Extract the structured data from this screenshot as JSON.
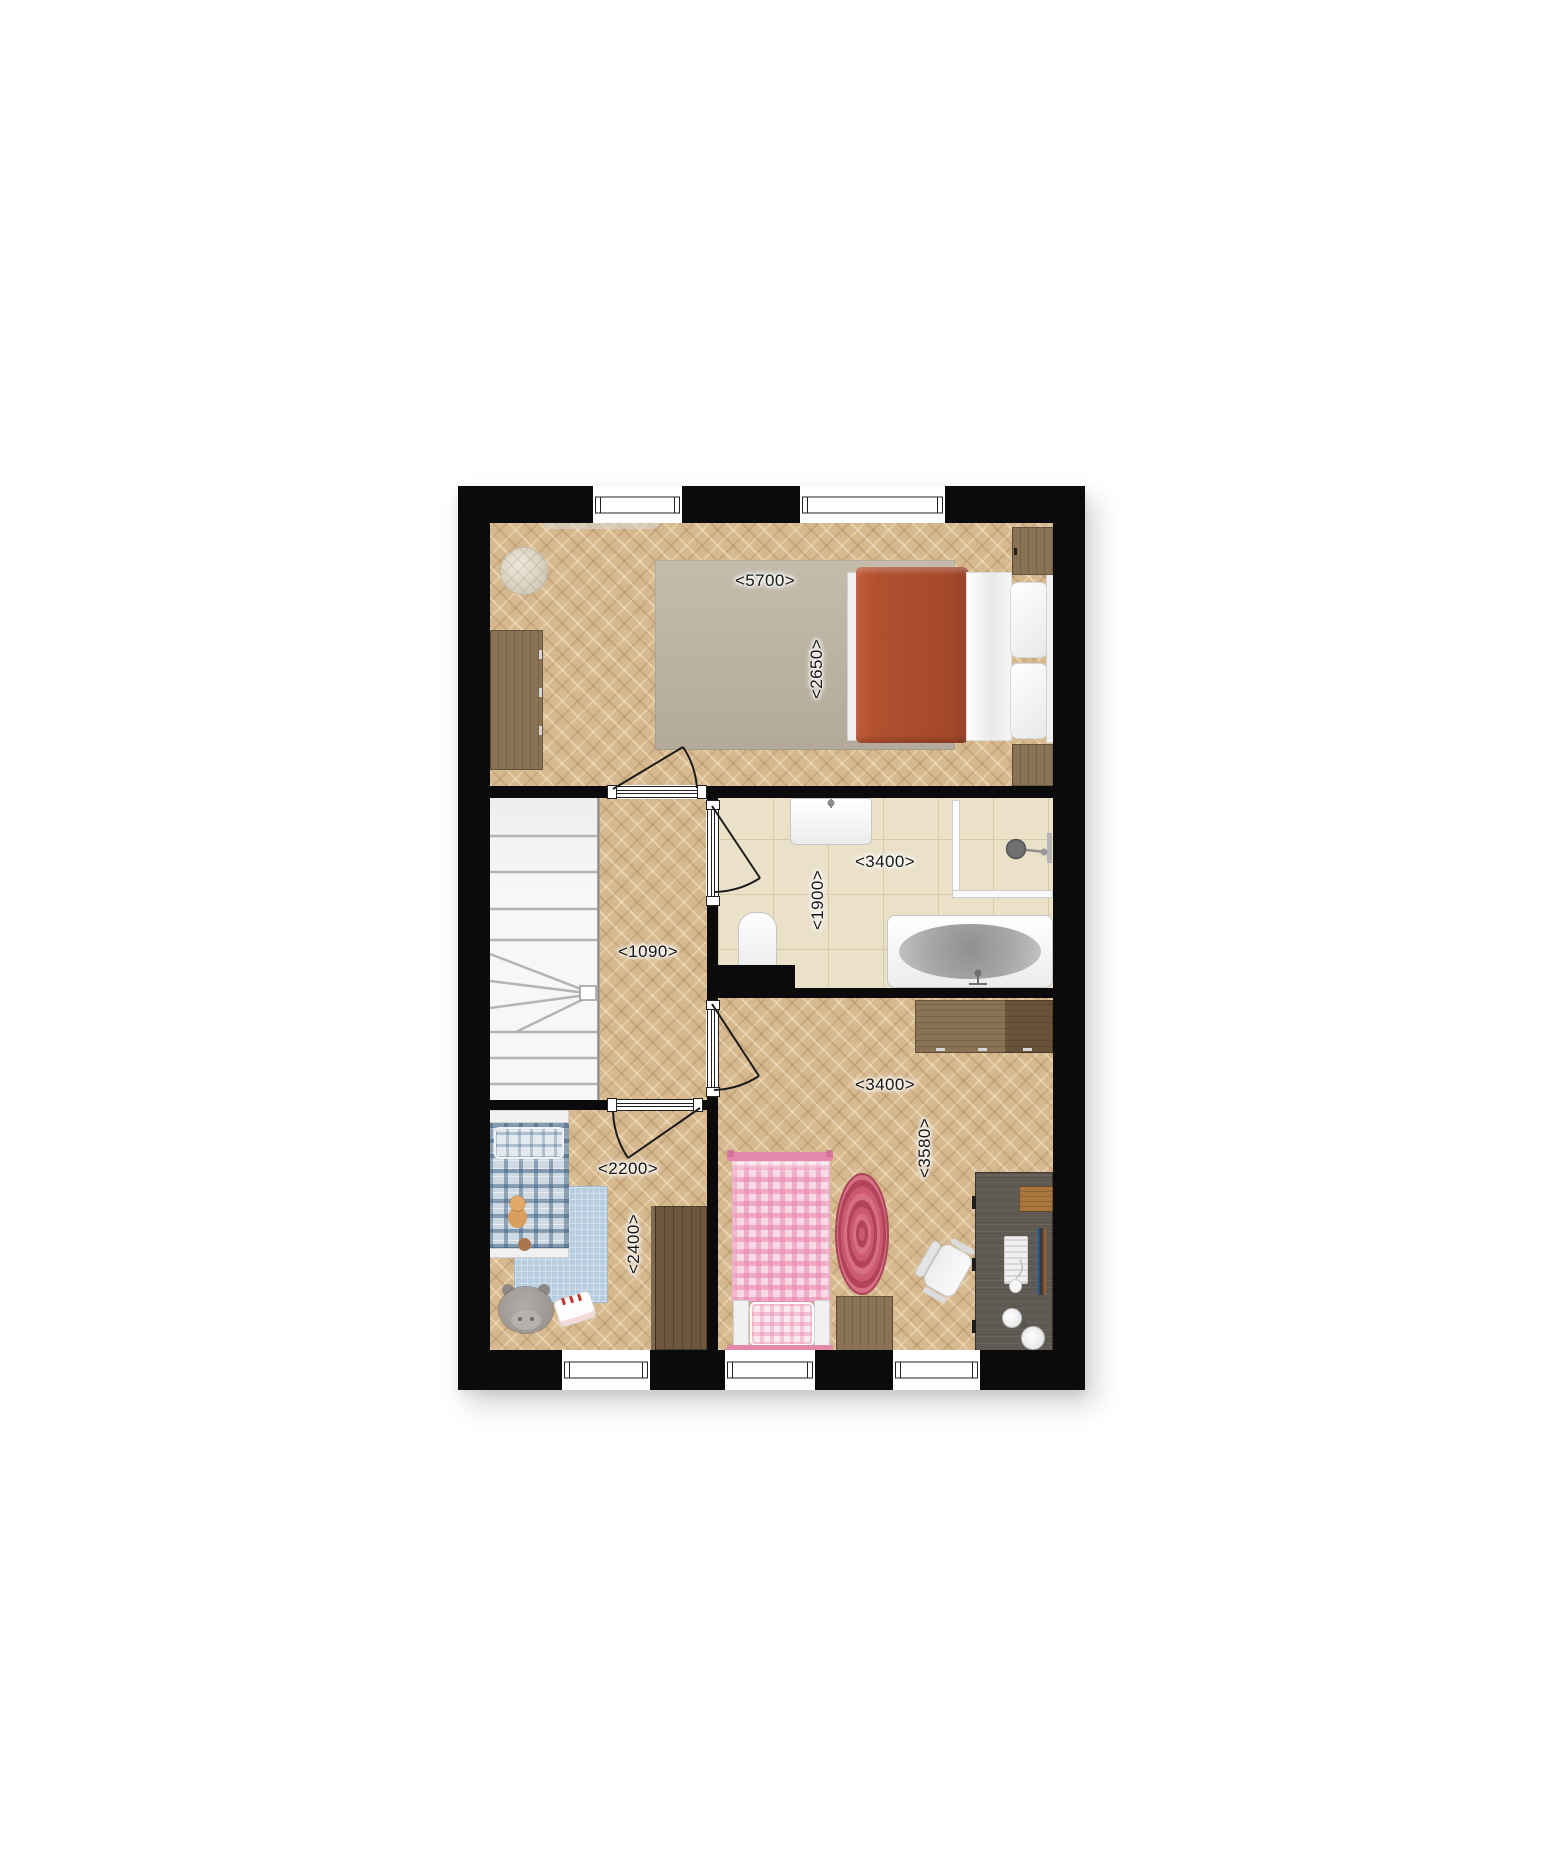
{
  "plan": {
    "type": "architectural-floor-plan",
    "dimension_labels": {
      "master_bedroom_width": "<5700>",
      "master_bedroom_depth": "<2650>",
      "bathroom_width": "<3400>",
      "bathroom_depth": "<1900>",
      "hallway_width": "<1090>",
      "kids_room_width": "<2200>",
      "kids_room_depth": "<2400>",
      "bedroom_width": "<3400>",
      "bedroom_depth": "<3580>"
    },
    "icons": [
      "stairs-icon",
      "door-swing-icon",
      "window-icon",
      "toilet-icon",
      "washbasin-icon",
      "bathtub-icon",
      "shower-head-icon",
      "double-bed-icon",
      "single-bed-icon",
      "desk-chair-icon",
      "desk-lamp-icon",
      "teddy-bear-icon",
      "hippo-plush-icon"
    ],
    "colors": {
      "wall": "#0b0b0b",
      "wood_base": "#d7b98f",
      "tile": "#ebe1c9",
      "tile_line": "#d6caa9",
      "stair_bg": "#f7f7f7",
      "rug_gray": "#beb4a2",
      "blanket_red": "#b1502f",
      "wood_furniture": "#8a7254",
      "wood_furniture_dark": "#6d573e",
      "desk_gray": "#5e5952",
      "plaid_base": "#cfd9e1",
      "rug_blue": "#b7cde0",
      "pink_base": "#f7d9e4",
      "rug_pink": "#c14f66"
    }
  }
}
